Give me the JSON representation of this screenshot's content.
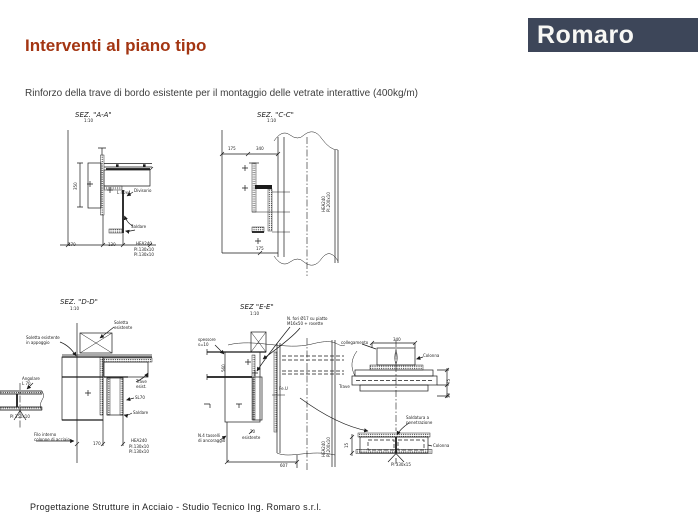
{
  "page": {
    "title": "Interventi al piano tipo",
    "subtitle": "Rinforzo della trave di bordo esistente per il montaggio delle vetrate interattive (400kg/m)",
    "footer": "Progettazione Strutture in Acciaio - Studio Tecnico Ing. Romaro s.r.l."
  },
  "logo": {
    "text": "Romaro",
    "bg_color": "#3d4659",
    "text_color": "#f7f7f4"
  },
  "colors": {
    "title": "#a33512",
    "body_text": "#3d3d3d",
    "line": "#1a1a1a"
  },
  "drawings": [
    {
      "id": "sez-aa",
      "label": "SEZ. \"A-A\"",
      "scale": "1:10"
    },
    {
      "id": "sez-cc",
      "label": "SEZ. \"C-C\"",
      "scale": "1:10"
    },
    {
      "id": "sez-dd",
      "label": "SEZ. \"D-D\"",
      "scale": "1:10"
    },
    {
      "id": "sez-ee",
      "label": "SEZ \"E-E\"",
      "scale": "1:10"
    }
  ],
  "annotations": [
    {
      "x": 84,
      "y": 119,
      "t": "1:10"
    },
    {
      "x": 267,
      "y": 119,
      "t": "1:10"
    },
    {
      "x": 70,
      "y": 307,
      "t": "1:10"
    },
    {
      "x": 250,
      "y": 312,
      "t": "1:10"
    },
    {
      "x": 74,
      "y": 190,
      "t": "350",
      "r": -90
    },
    {
      "x": 117,
      "y": 191,
      "t": "L 40x4"
    },
    {
      "x": 134,
      "y": 189,
      "t": "Divisorio"
    },
    {
      "x": 131,
      "y": 225,
      "t": "Saldare"
    },
    {
      "x": 68,
      "y": 243,
      "t": "170"
    },
    {
      "x": 108,
      "y": 243,
      "t": "130"
    },
    {
      "x": 136,
      "y": 242,
      "t": "HEA240"
    },
    {
      "x": 134,
      "y": 248,
      "t": "Pl.130x10"
    },
    {
      "x": 134,
      "y": 253,
      "t": "Pl.130x10"
    },
    {
      "x": 228,
      "y": 147,
      "t": "175"
    },
    {
      "x": 256,
      "y": 147,
      "t": "340"
    },
    {
      "x": 256,
      "y": 247,
      "t": "175"
    },
    {
      "x": 322,
      "y": 212,
      "t": "HEA240",
      "r": -90
    },
    {
      "x": 327,
      "y": 212,
      "t": "Pl.200x10",
      "r": -90
    },
    {
      "x": 114,
      "y": 321,
      "t": "Soletta"
    },
    {
      "x": 114,
      "y": 326,
      "t": "esistente"
    },
    {
      "x": 26,
      "y": 336,
      "t": "Soletta esistente"
    },
    {
      "x": 26,
      "y": 341,
      "t": "in appoggio"
    },
    {
      "x": 136,
      "y": 380,
      "t": "Trave"
    },
    {
      "x": 136,
      "y": 385,
      "t": "esist."
    },
    {
      "x": 135,
      "y": 396,
      "t": "SL70"
    },
    {
      "x": 133,
      "y": 411,
      "t": "Saldare"
    },
    {
      "x": 93,
      "y": 442,
      "t": "170"
    },
    {
      "x": 131,
      "y": 439,
      "t": "HEA240"
    },
    {
      "x": 129,
      "y": 445,
      "t": "Pl.130x10"
    },
    {
      "x": 129,
      "y": 450,
      "t": "Pl.130x10"
    },
    {
      "x": 22,
      "y": 377,
      "t": "Angolare"
    },
    {
      "x": 22,
      "y": 382,
      "t": "L 70"
    },
    {
      "x": 10,
      "y": 415,
      "t": "Pl 350x10"
    },
    {
      "x": 34,
      "y": 433,
      "t": "Filo interno"
    },
    {
      "x": 34,
      "y": 438,
      "t": "colonne di acciaio"
    },
    {
      "x": 287,
      "y": 317,
      "t": "N. fori Ø17 su piatto"
    },
    {
      "x": 287,
      "y": 322,
      "t": "M16x50 + rosette"
    },
    {
      "x": 198,
      "y": 338,
      "t": "spessore"
    },
    {
      "x": 198,
      "y": 343,
      "t": "s=10"
    },
    {
      "x": 198,
      "y": 434,
      "t": "N.4 tasselli"
    },
    {
      "x": 198,
      "y": 439,
      "t": "di ancoraggio"
    },
    {
      "x": 250,
      "y": 430,
      "t": "20"
    },
    {
      "x": 280,
      "y": 464,
      "t": "607"
    },
    {
      "x": 322,
      "y": 457,
      "t": "HEA240",
      "r": -90
    },
    {
      "x": 327,
      "y": 457,
      "t": "Pl.200x10",
      "r": -90
    },
    {
      "x": 222,
      "y": 372,
      "t": "560",
      "r": -90
    },
    {
      "x": 279,
      "y": 387,
      "t": "Fe.U"
    },
    {
      "x": 242,
      "y": 436,
      "t": "esistente"
    },
    {
      "x": 341,
      "y": 341,
      "t": "collegamento"
    },
    {
      "x": 393,
      "y": 338,
      "t": "340"
    },
    {
      "x": 423,
      "y": 354,
      "t": "Colonna"
    },
    {
      "x": 447,
      "y": 384,
      "t": "75",
      "r": -90
    },
    {
      "x": 447,
      "y": 398,
      "t": "30",
      "r": -90
    },
    {
      "x": 339,
      "y": 385,
      "t": "Trave"
    },
    {
      "x": 406,
      "y": 416,
      "t": "Saldatura a"
    },
    {
      "x": 406,
      "y": 421,
      "t": "penetrazione"
    },
    {
      "x": 433,
      "y": 444,
      "t": "Colonna"
    },
    {
      "x": 391,
      "y": 463,
      "t": "Pl 330x15"
    },
    {
      "x": 345,
      "y": 448,
      "t": "15",
      "r": -90
    }
  ]
}
